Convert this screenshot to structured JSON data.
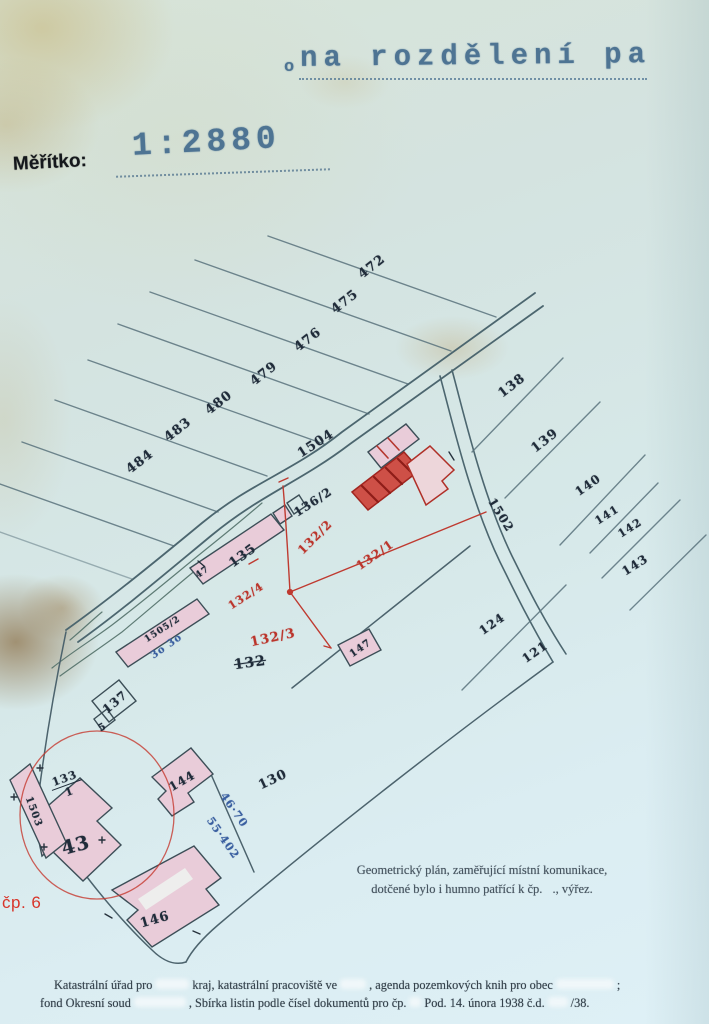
{
  "stamp": {
    "prefix": "o",
    "text": "na rozdělení pa"
  },
  "scale": {
    "label": "Měřítko:",
    "value": "1:2880"
  },
  "labels": {
    "p472": "472",
    "p475": "475",
    "p476": "476",
    "p479": "479",
    "p480": "480",
    "p483": "483",
    "p484": "484",
    "road1504": "1504",
    "road1502": "1502",
    "p138": "138",
    "p139": "139",
    "p140": "140",
    "p141": "141",
    "p142": "142",
    "p143": "143",
    "p124": "124",
    "p121": "121",
    "p136_2": "136/2",
    "p135": "135",
    "p132": "132",
    "p137": "137",
    "p5": "5",
    "p47": "47",
    "p1505_2": "1505/2",
    "p147": "147",
    "p144": "144",
    "p130": "130",
    "p43": "43",
    "p146": "146",
    "p1503": "1503",
    "p133_num": "133",
    "p133_den": "1",
    "r132_2": "132/2",
    "r132_1": "132/1",
    "r132_4": "132/4",
    "r132_3": "132/3",
    "m46_70": "46·70",
    "m55_402": "55·402",
    "m3030": "3o 3o"
  },
  "annotation": {
    "cp6": "čp. 6"
  },
  "caption": {
    "line1": "Geometrický plán, zaměřující místní komunikace,",
    "line2a": "dotčené bylo i humno patřící k čp.",
    "line2b": "., výřez."
  },
  "footer": {
    "l1a": "Katastrální úřad pro",
    "l1b": "kraj, katastrální pracoviště ve",
    "l1c": ", agenda pozemkových knih pro obec",
    "l1d": ";",
    "l2a": "fond Okresní soud",
    "l2b": ", Sbírka listin podle čísel dokumentů pro čp.",
    "l2c": "Pod. 14. února 1938 č.d.",
    "l2d": "/38."
  },
  "colors": {
    "ink_blue": "#4e7493",
    "map_line": "#5a737d",
    "red_ink": "#bb352c",
    "pink_building": "#e9ccd9",
    "hand_blue": "#3a5fa0",
    "label_dark": "#202c3a"
  }
}
